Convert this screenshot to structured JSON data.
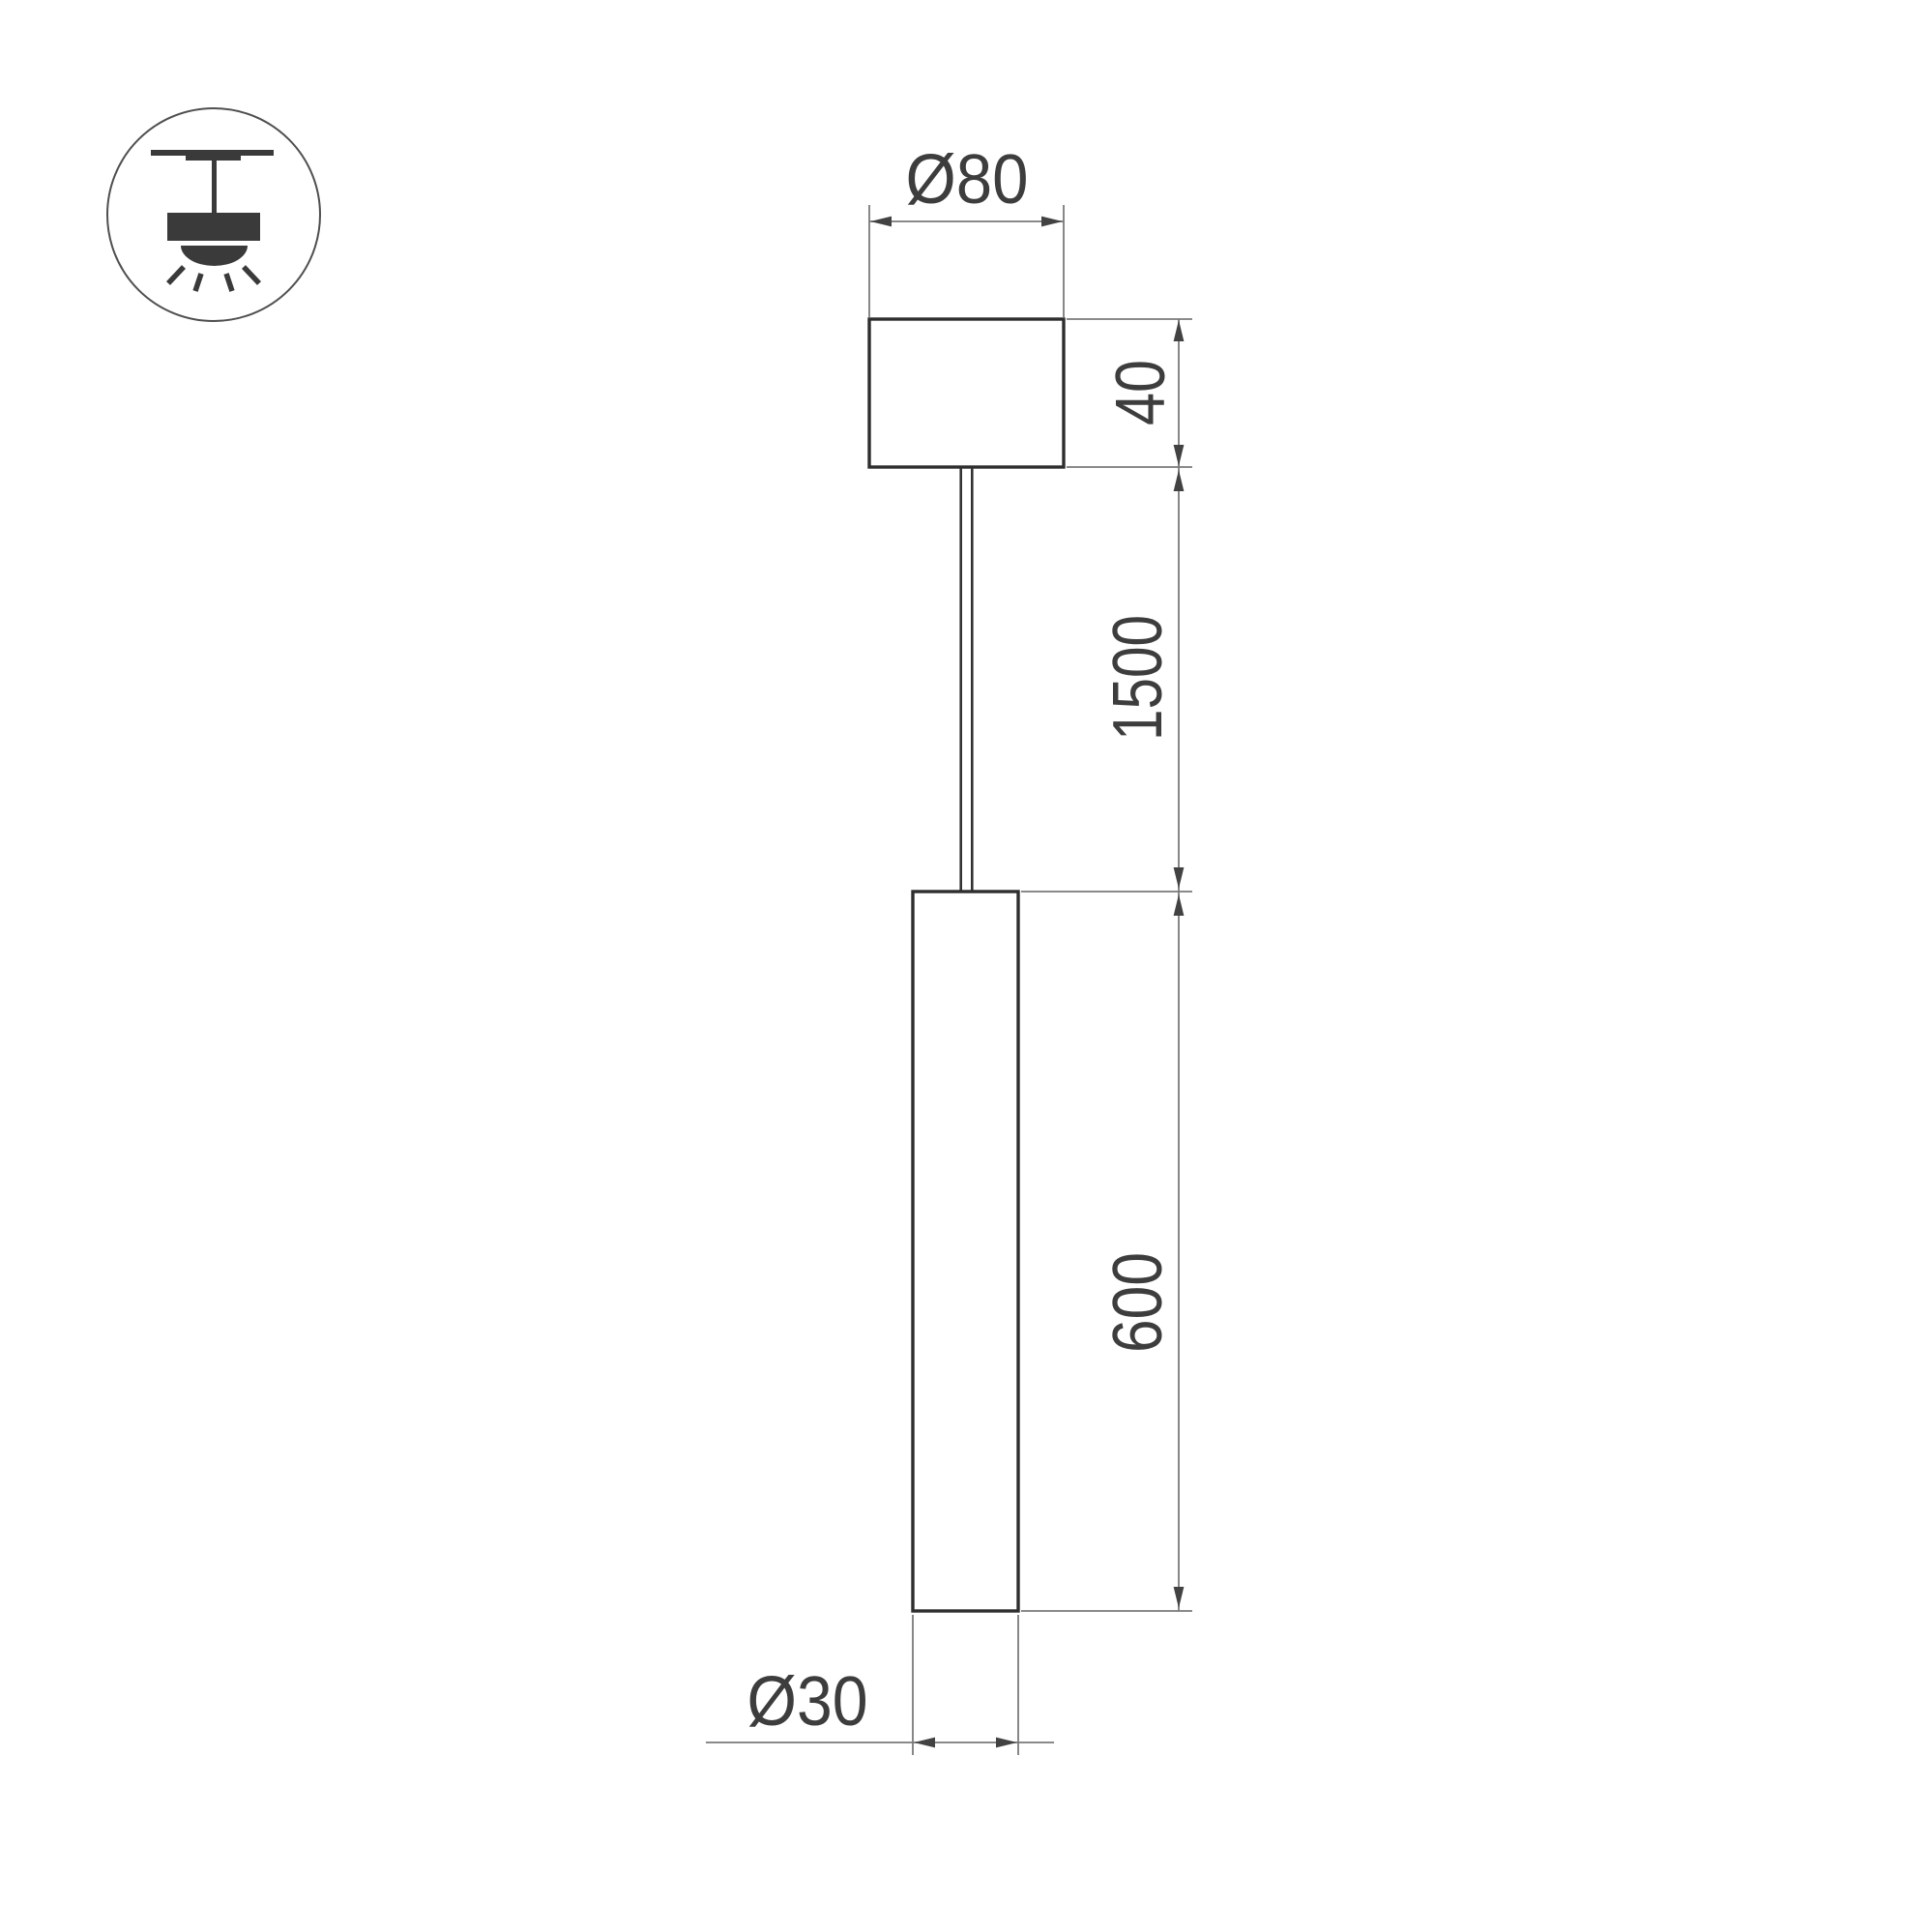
{
  "page": {
    "background_color": "#ffffff",
    "type": "technical-dimension-drawing",
    "subject": "pendant LED tube luminaire"
  },
  "icon": {
    "name": "pendant-ceiling-light-icon",
    "description": "ceiling-mounted pendant lamp with downward light rays inside a circle",
    "color": "#3a3a3a",
    "circle_color": "#4f4f4f"
  },
  "colors": {
    "outline": "#2e2e2e",
    "dimension_lines": "#7a7a7a",
    "dimension_text": "#3d3d3d",
    "arrows": "#424242"
  },
  "dimensions": {
    "canopy_diameter": {
      "label": "Ø80",
      "value_mm": 80
    },
    "canopy_height": {
      "label": "40",
      "value_mm": 40
    },
    "suspension_length": {
      "label": "1500",
      "value_mm": 1500
    },
    "tube_length": {
      "label": "600",
      "value_mm": 600
    },
    "tube_diameter": {
      "label": "Ø30",
      "value_mm": 30
    }
  }
}
